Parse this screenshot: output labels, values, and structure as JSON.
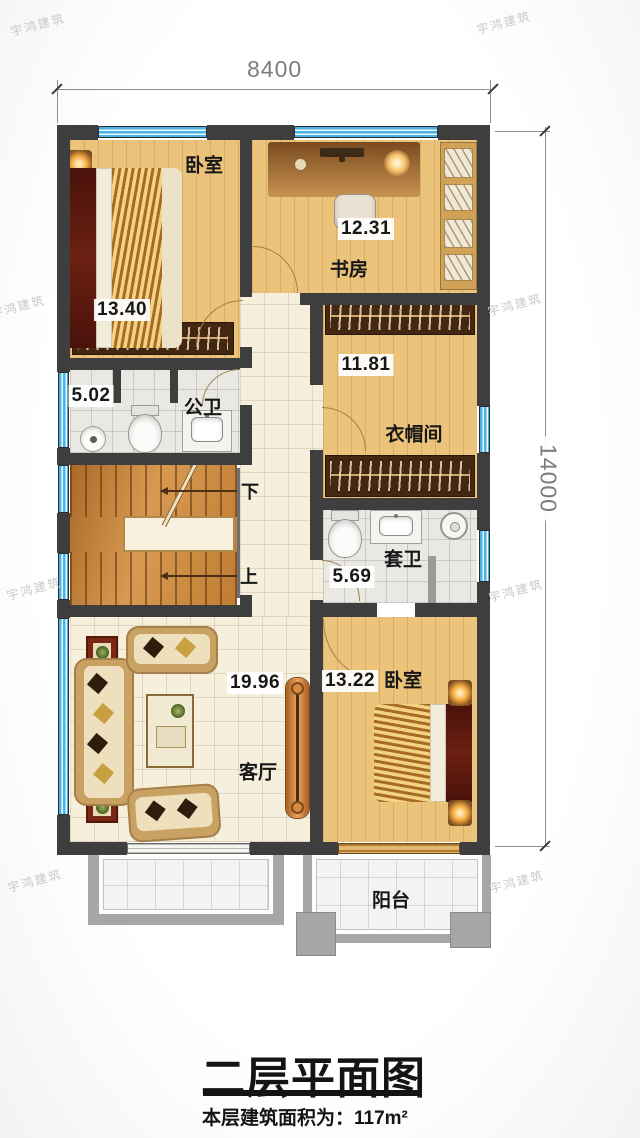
{
  "watermark": {
    "text": "宇鸿建筑"
  },
  "dimensions": {
    "width_mm": "8400",
    "height_mm": "14000"
  },
  "floorplan": {
    "rooms": {
      "bedroom_top": {
        "label": "卧室",
        "area": "13.40"
      },
      "study": {
        "label": "书房",
        "area": "12.31"
      },
      "public_bath": {
        "label": "公卫",
        "area": "5.02"
      },
      "cloakroom": {
        "label": "衣帽间",
        "area": "11.81"
      },
      "ensuite_bath": {
        "label": "套卫",
        "area": "5.69"
      },
      "living_room": {
        "label": "客厅",
        "area": "19.96"
      },
      "bedroom_bottom": {
        "label": "卧室",
        "area": "13.22"
      },
      "balcony": {
        "label": "阳台"
      }
    },
    "stairs": {
      "down_label": "下",
      "up_label": "上"
    }
  },
  "footer": {
    "title": "二层平面图",
    "area_note": "本层建筑面积为：117m²"
  },
  "colors": {
    "wall": "#3e3e3e",
    "window_blue": "#49b4e3",
    "wood_floor": "#ecc37a",
    "hall_floor": "#f5efdc",
    "bath_floor": "#eae8e3",
    "stair_wood": "#c98a45",
    "balcony_frame": "#a6a6a6"
  }
}
